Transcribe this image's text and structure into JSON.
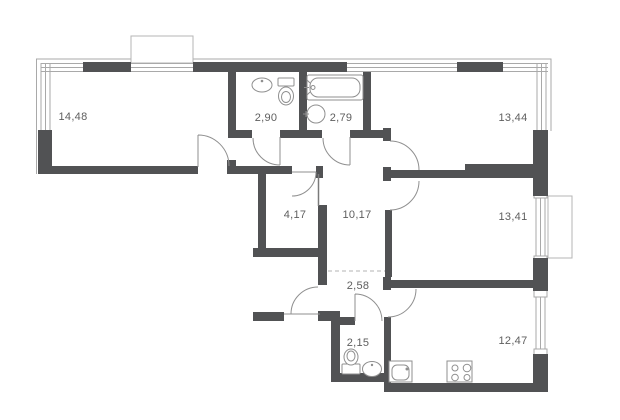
{
  "plan": {
    "type": "apartment-floor-plan",
    "rooms": [
      {
        "name": "living-room",
        "area": "14,48"
      },
      {
        "name": "bathroom",
        "area": "2,90"
      },
      {
        "name": "bathroom-with-tub",
        "area": "2,79"
      },
      {
        "name": "bedroom-top-right",
        "area": "13,44"
      },
      {
        "name": "wardrobe",
        "area": "4,17"
      },
      {
        "name": "hallway",
        "area": "10,17"
      },
      {
        "name": "bedroom-right",
        "area": "13,41"
      },
      {
        "name": "corridor",
        "area": "2,58"
      },
      {
        "name": "wc",
        "area": "2,15"
      },
      {
        "name": "kitchen-living",
        "area": "12,47"
      }
    ],
    "fixtures": [
      "sink",
      "toilet",
      "bathtub",
      "sink",
      "toilet",
      "sink",
      "kitchen-sink",
      "stove"
    ],
    "features": [
      "balcony-top",
      "balcony-right",
      "entry-door",
      "dashed-zone-divider"
    ],
    "colors": {
      "wall": "#515254",
      "line": "#a9a9a9",
      "door": "#8f8f8f",
      "fixture": "#8f8f8f",
      "label": "#5e5e5e",
      "balcony": "#b5b5b5",
      "dashed": "#b3b3b3",
      "background": "#ffffff"
    }
  }
}
